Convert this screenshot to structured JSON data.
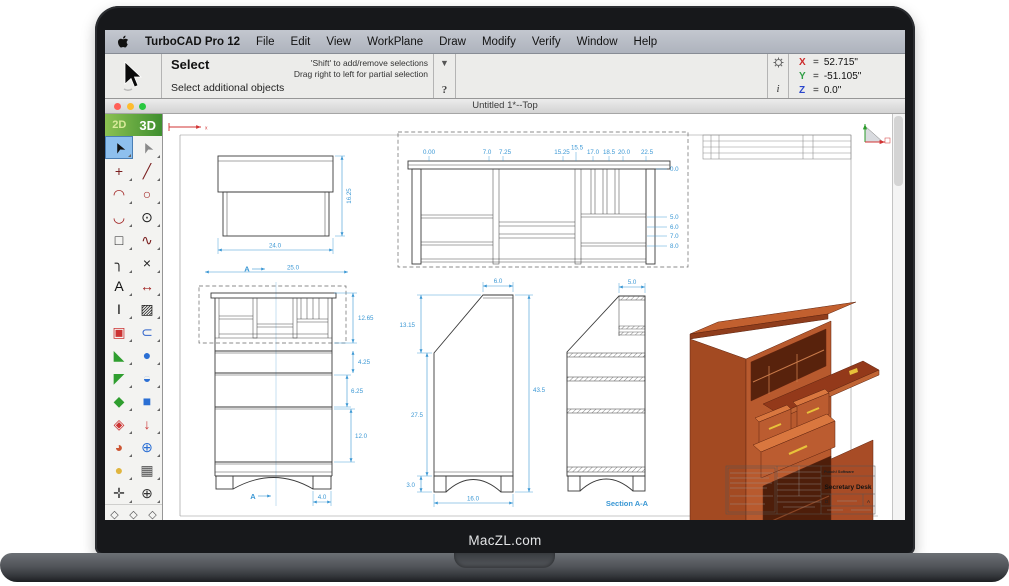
{
  "laptop": {
    "brand": "MacZL.com"
  },
  "menu_bar": {
    "app_name": "TurboCAD Pro 12",
    "items": [
      "File",
      "Edit",
      "View",
      "WorkPlane",
      "Draw",
      "Modify",
      "Verify",
      "Window",
      "Help"
    ]
  },
  "tool_options_bar": {
    "tool_title": "Select",
    "status": "Select additional objects",
    "hint1": "'Shift' to add/remove selections",
    "hint2": "Drag right to left for partial selection",
    "dropdown_glyph": "▼",
    "help_glyph": "?",
    "coordinates": {
      "rows": [
        {
          "label": "X",
          "value": "52.715\"",
          "color": "#cc2a2a"
        },
        {
          "label": "Y",
          "value": "-51.105\"",
          "color": "#2f9e44"
        },
        {
          "label": "Z",
          "value": "0.0\"",
          "color": "#2a46cc"
        }
      ]
    }
  },
  "window": {
    "title": "Untitled 1*--Top"
  },
  "tool_palette": {
    "mode_2d": "2D",
    "mode_3d": "3D",
    "tools": [
      {
        "name": "select-tool",
        "glyph": "➤",
        "color": "#111111",
        "rotate": -115,
        "selected": true
      },
      {
        "name": "select-open-tool",
        "glyph": "➤",
        "color": "#8a8a8a",
        "rotate": -115
      },
      {
        "name": "point-tool",
        "glyph": "+",
        "color": "#7a1f1f"
      },
      {
        "name": "line-tool",
        "glyph": "╱",
        "color": "#7a1f1f"
      },
      {
        "name": "arc-tool",
        "glyph": "◠",
        "color": "#a02020"
      },
      {
        "name": "circle-tool",
        "glyph": "○",
        "color": "#a02020"
      },
      {
        "name": "curve-tool",
        "glyph": "◡",
        "color": "#a02020"
      },
      {
        "name": "ellipse-tool",
        "glyph": "⊙",
        "color": "#222222"
      },
      {
        "name": "rectangle-tool",
        "glyph": "□",
        "color": "#222222"
      },
      {
        "name": "spline-tool",
        "glyph": "∿",
        "color": "#7a1f1f"
      },
      {
        "name": "fillet-tool",
        "glyph": "╮",
        "color": "#222222"
      },
      {
        "name": "trim-tool",
        "glyph": "×",
        "color": "#222222"
      },
      {
        "name": "text-tool",
        "glyph": "A",
        "color": "#111111"
      },
      {
        "name": "dimension-tool",
        "glyph": "↔",
        "color": "#a02020"
      },
      {
        "name": "vertical-dimension-tool",
        "glyph": "I",
        "color": "#111111"
      },
      {
        "name": "hatch-tool",
        "glyph": "▨",
        "color": "#222222"
      },
      {
        "name": "copy-tool",
        "glyph": "▣",
        "color": "#cc3333"
      },
      {
        "name": "snap-magnet-tool",
        "glyph": "⊂",
        "color": "#3366cc"
      },
      {
        "name": "mesh-surface-tool",
        "glyph": "◣",
        "color": "#2f9e2f"
      },
      {
        "name": "sphere-tool",
        "glyph": "●",
        "color": "#2b6fd4"
      },
      {
        "name": "rotate-3d-tool",
        "glyph": "◤",
        "color": "#2f9e2f"
      },
      {
        "name": "dome-tool",
        "glyph": "◒",
        "color": "#2b6fd4"
      },
      {
        "name": "workplane-tool",
        "glyph": "◆",
        "color": "#2f9e2f"
      },
      {
        "name": "box-3d-tool",
        "glyph": "■",
        "color": "#2b6fd4"
      },
      {
        "name": "layer-stack-tool",
        "glyph": "◈",
        "color": "#cc3333"
      },
      {
        "name": "extrude-tool",
        "glyph": "↓",
        "color": "#cc3333"
      },
      {
        "name": "revolve-tool",
        "glyph": "◕",
        "color": "#cc5533"
      },
      {
        "name": "boolean-add-tool",
        "glyph": "⊕",
        "color": "#2b6fd4"
      },
      {
        "name": "material-tool",
        "glyph": "●",
        "color": "#e0b53e"
      },
      {
        "name": "viewport-grid-tool",
        "glyph": "▦",
        "color": "#555555"
      },
      {
        "name": "pan-tool",
        "glyph": "✛",
        "color": "#444444"
      },
      {
        "name": "zoom-in-tool",
        "glyph": "⊕",
        "color": "#333333"
      }
    ],
    "view_cubes": [
      {
        "name": "view-cube-wire-1",
        "glyph": "◇"
      },
      {
        "name": "view-cube-wire-2",
        "glyph": "◇"
      },
      {
        "name": "view-cube-wire-3",
        "glyph": "◇"
      },
      {
        "name": "view-cube-shaded",
        "glyph": "◆",
        "selected": true
      },
      {
        "name": "view-cube-wire-4",
        "glyph": "◇"
      },
      {
        "name": "view-cube-grid",
        "glyph": "▦"
      }
    ]
  },
  "drawing": {
    "dim_color": "#3a97d4",
    "wood_color": "#b85a2e",
    "handle_color": "#e8c23a",
    "axis_label_x": "x",
    "top_view": {
      "height_dim": "16.25",
      "width_dim": "24.0",
      "overall_dim": "25.0",
      "section_label": "A"
    },
    "detail_view": {
      "top_dims": [
        "0.00",
        "7.0",
        "7.25",
        "15.25",
        "15.5",
        "17.0",
        "18.5",
        "20.0",
        "22.5"
      ],
      "right_dims": [
        "0.0",
        "5.0",
        "6.0",
        "7.0",
        "8.0"
      ]
    },
    "front_view": {
      "hutch_dim": "12.65",
      "gap_dim": "4.25",
      "drawer_dim": "6.25",
      "lower_dim": "12.0",
      "foot_dim": "4.0",
      "section_label": "A"
    },
    "side_view": {
      "top_dim": "6.0",
      "slant_dim": "13.15",
      "body_dim": "27.5",
      "base_dim": "3.0",
      "height_dim": "43.5",
      "depth_dim": "16.0"
    },
    "section_view": {
      "top_dim": "5.0",
      "label": "Section A-A"
    },
    "title_block": {
      "company": "Punch! Software",
      "title": "Secretary Desk",
      "cell_left": "D",
      "cell_right": "A"
    }
  }
}
